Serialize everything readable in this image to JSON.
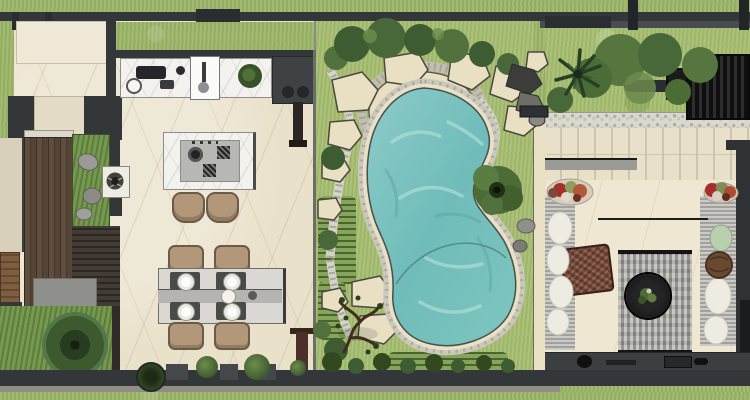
{
  "scene": {
    "type": "architectural-site-plan",
    "view": "top-down 2D color rendering",
    "canvas": "750x400",
    "visible_text": "none"
  },
  "areas": [
    {
      "id": "kitchen",
      "label": "kitchen with wall counter and cooktop island"
    },
    {
      "id": "dining-area",
      "label": "dining table for four with runner and place settings"
    },
    {
      "id": "wood-deck",
      "label": "vertical plank timber deck, left side"
    },
    {
      "id": "planting-beds",
      "label": "interior planting beds with rocks and feature tree"
    },
    {
      "id": "garden",
      "label": "central lawn garden with stepping-stone paths"
    },
    {
      "id": "swimming-pool",
      "label": "kidney-shaped pool with stone coping and pebble surround"
    },
    {
      "id": "lounge-terrace",
      "label": "right terrace with twin daybeds, rug and round fire table"
    },
    {
      "id": "pergola-screen",
      "label": "black slatted screen, top right"
    },
    {
      "id": "lawn-strips",
      "label": "perimeter lawn strips along walls"
    }
  ],
  "objects": {
    "pool": 1,
    "pool_stepping_stones": 12,
    "dining_chairs": 4,
    "dining_plates": 4,
    "bar_stools": 2,
    "daybeds": 2,
    "fire_table": 1,
    "palm_tree": 1,
    "flower_pots": 2,
    "armchair": 1,
    "rug": 1,
    "boulders": 3,
    "feature_tree": 1
  },
  "colors": {
    "wall": "#34373a",
    "wallLight": "#4a4d50",
    "floor": "#eae1ca",
    "marble": "#f3f2ee",
    "grass": "#9db66a",
    "gardenGrass": "#a8bf72",
    "water": "#7cc4c2",
    "waterDeep": "#5fa9a7",
    "waterLight": "#b8e2da",
    "coping": "#e9e0c6",
    "pebble": "#cbc8bc",
    "stone": "#e9e0c4",
    "stoneEdge": "#4c473f",
    "shrubDark": "#3e5c32",
    "shrubMid": "#52713f",
    "shrubLight": "#6d8d4a",
    "deckWood": "#55453a",
    "panelWood": "#7b5a3c",
    "tan": "#b29878",
    "tanEdge": "#6b5b48",
    "sofaGray": "#b9b8b4",
    "cushion": "#edebe2",
    "rug": "#a7a7a2",
    "firePit": "#181818",
    "flowerRed": "#a5302a",
    "potBrown": "#6a4931",
    "chairBrown": "#7a4a3a",
    "gravel": "#dad8cf",
    "paver": "#e8e0c9",
    "paverJoint": "#cfc5aa",
    "platform": "#8f8f8b",
    "rock": "#8e8e88",
    "counterPanel": "#b7b7b3",
    "tableGray": "#d9d8d3",
    "runner": "#b5b4b0",
    "mat": "#4a4a46"
  }
}
